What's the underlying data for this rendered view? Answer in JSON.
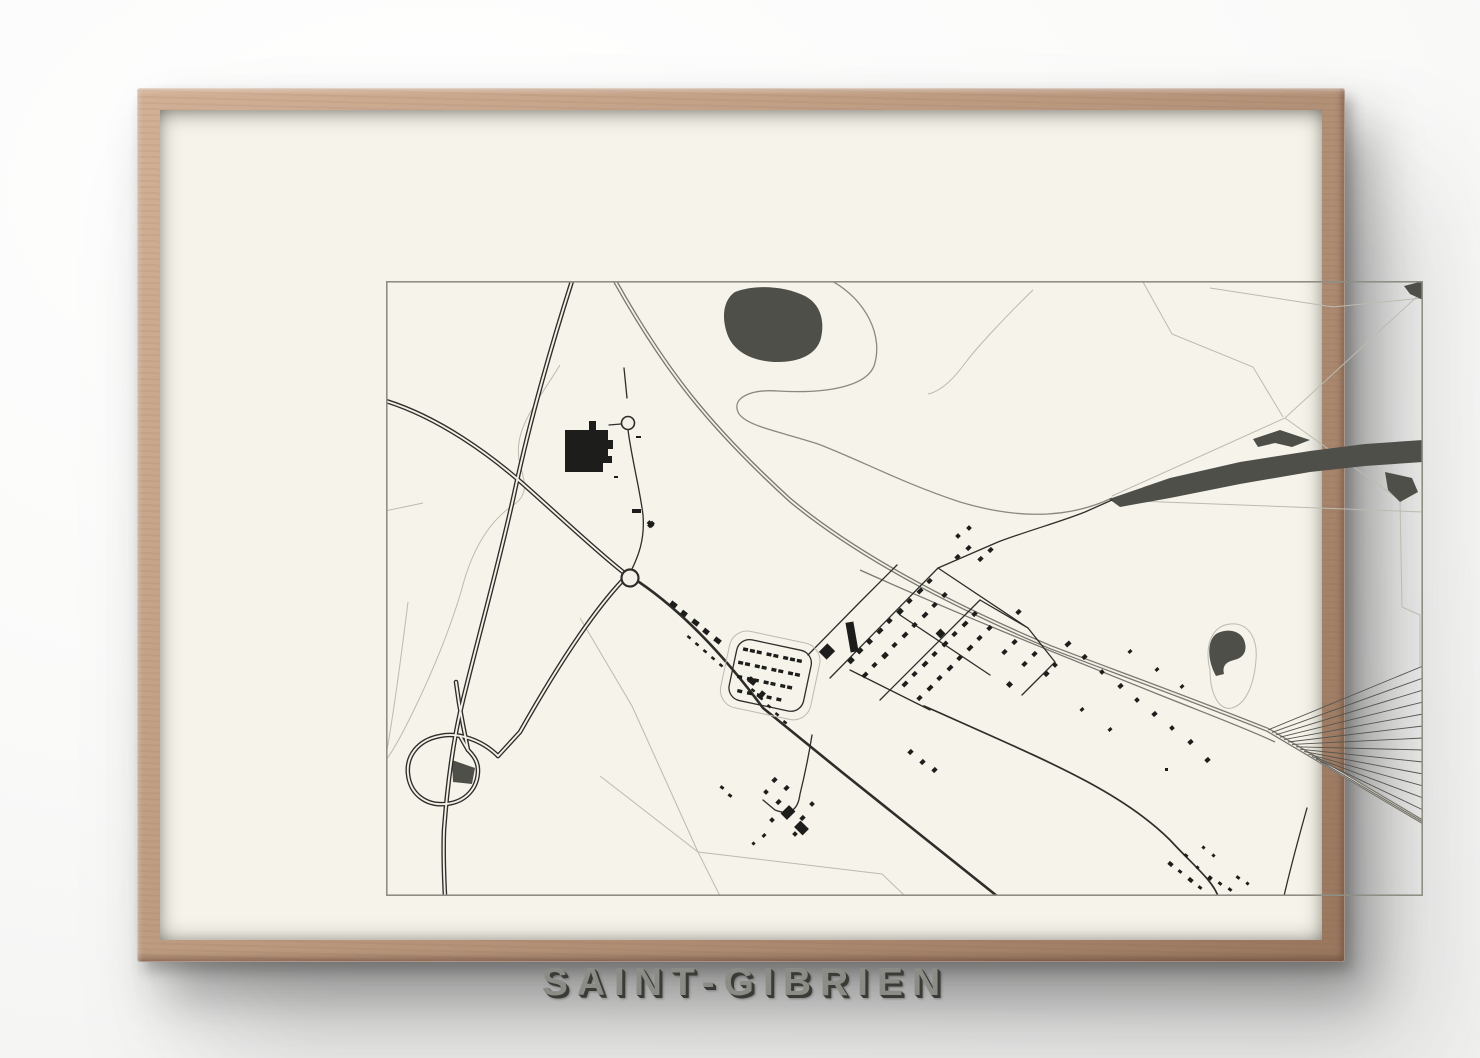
{
  "poster": {
    "title": "SAINT-GIBRIEN"
  },
  "colors": {
    "wall": "#fafaf9",
    "frame_wood_light": "#d2b096",
    "frame_wood": "#bb997f",
    "frame_wood_dark": "#99775f",
    "mat": "#f5f3ea",
    "paper": "#f3f1e7",
    "ink": "#1d1d1b",
    "road": "#2e2d2a",
    "rail": "#7a7870",
    "yard": "#55544e",
    "stream": "#8a897f",
    "light_line": "#bdbbb0",
    "wood_fill": "#4f4f4a",
    "border": "#8f8e85",
    "title_fill": "#8c8c86",
    "title_shadow": "#3b3a36"
  }
}
